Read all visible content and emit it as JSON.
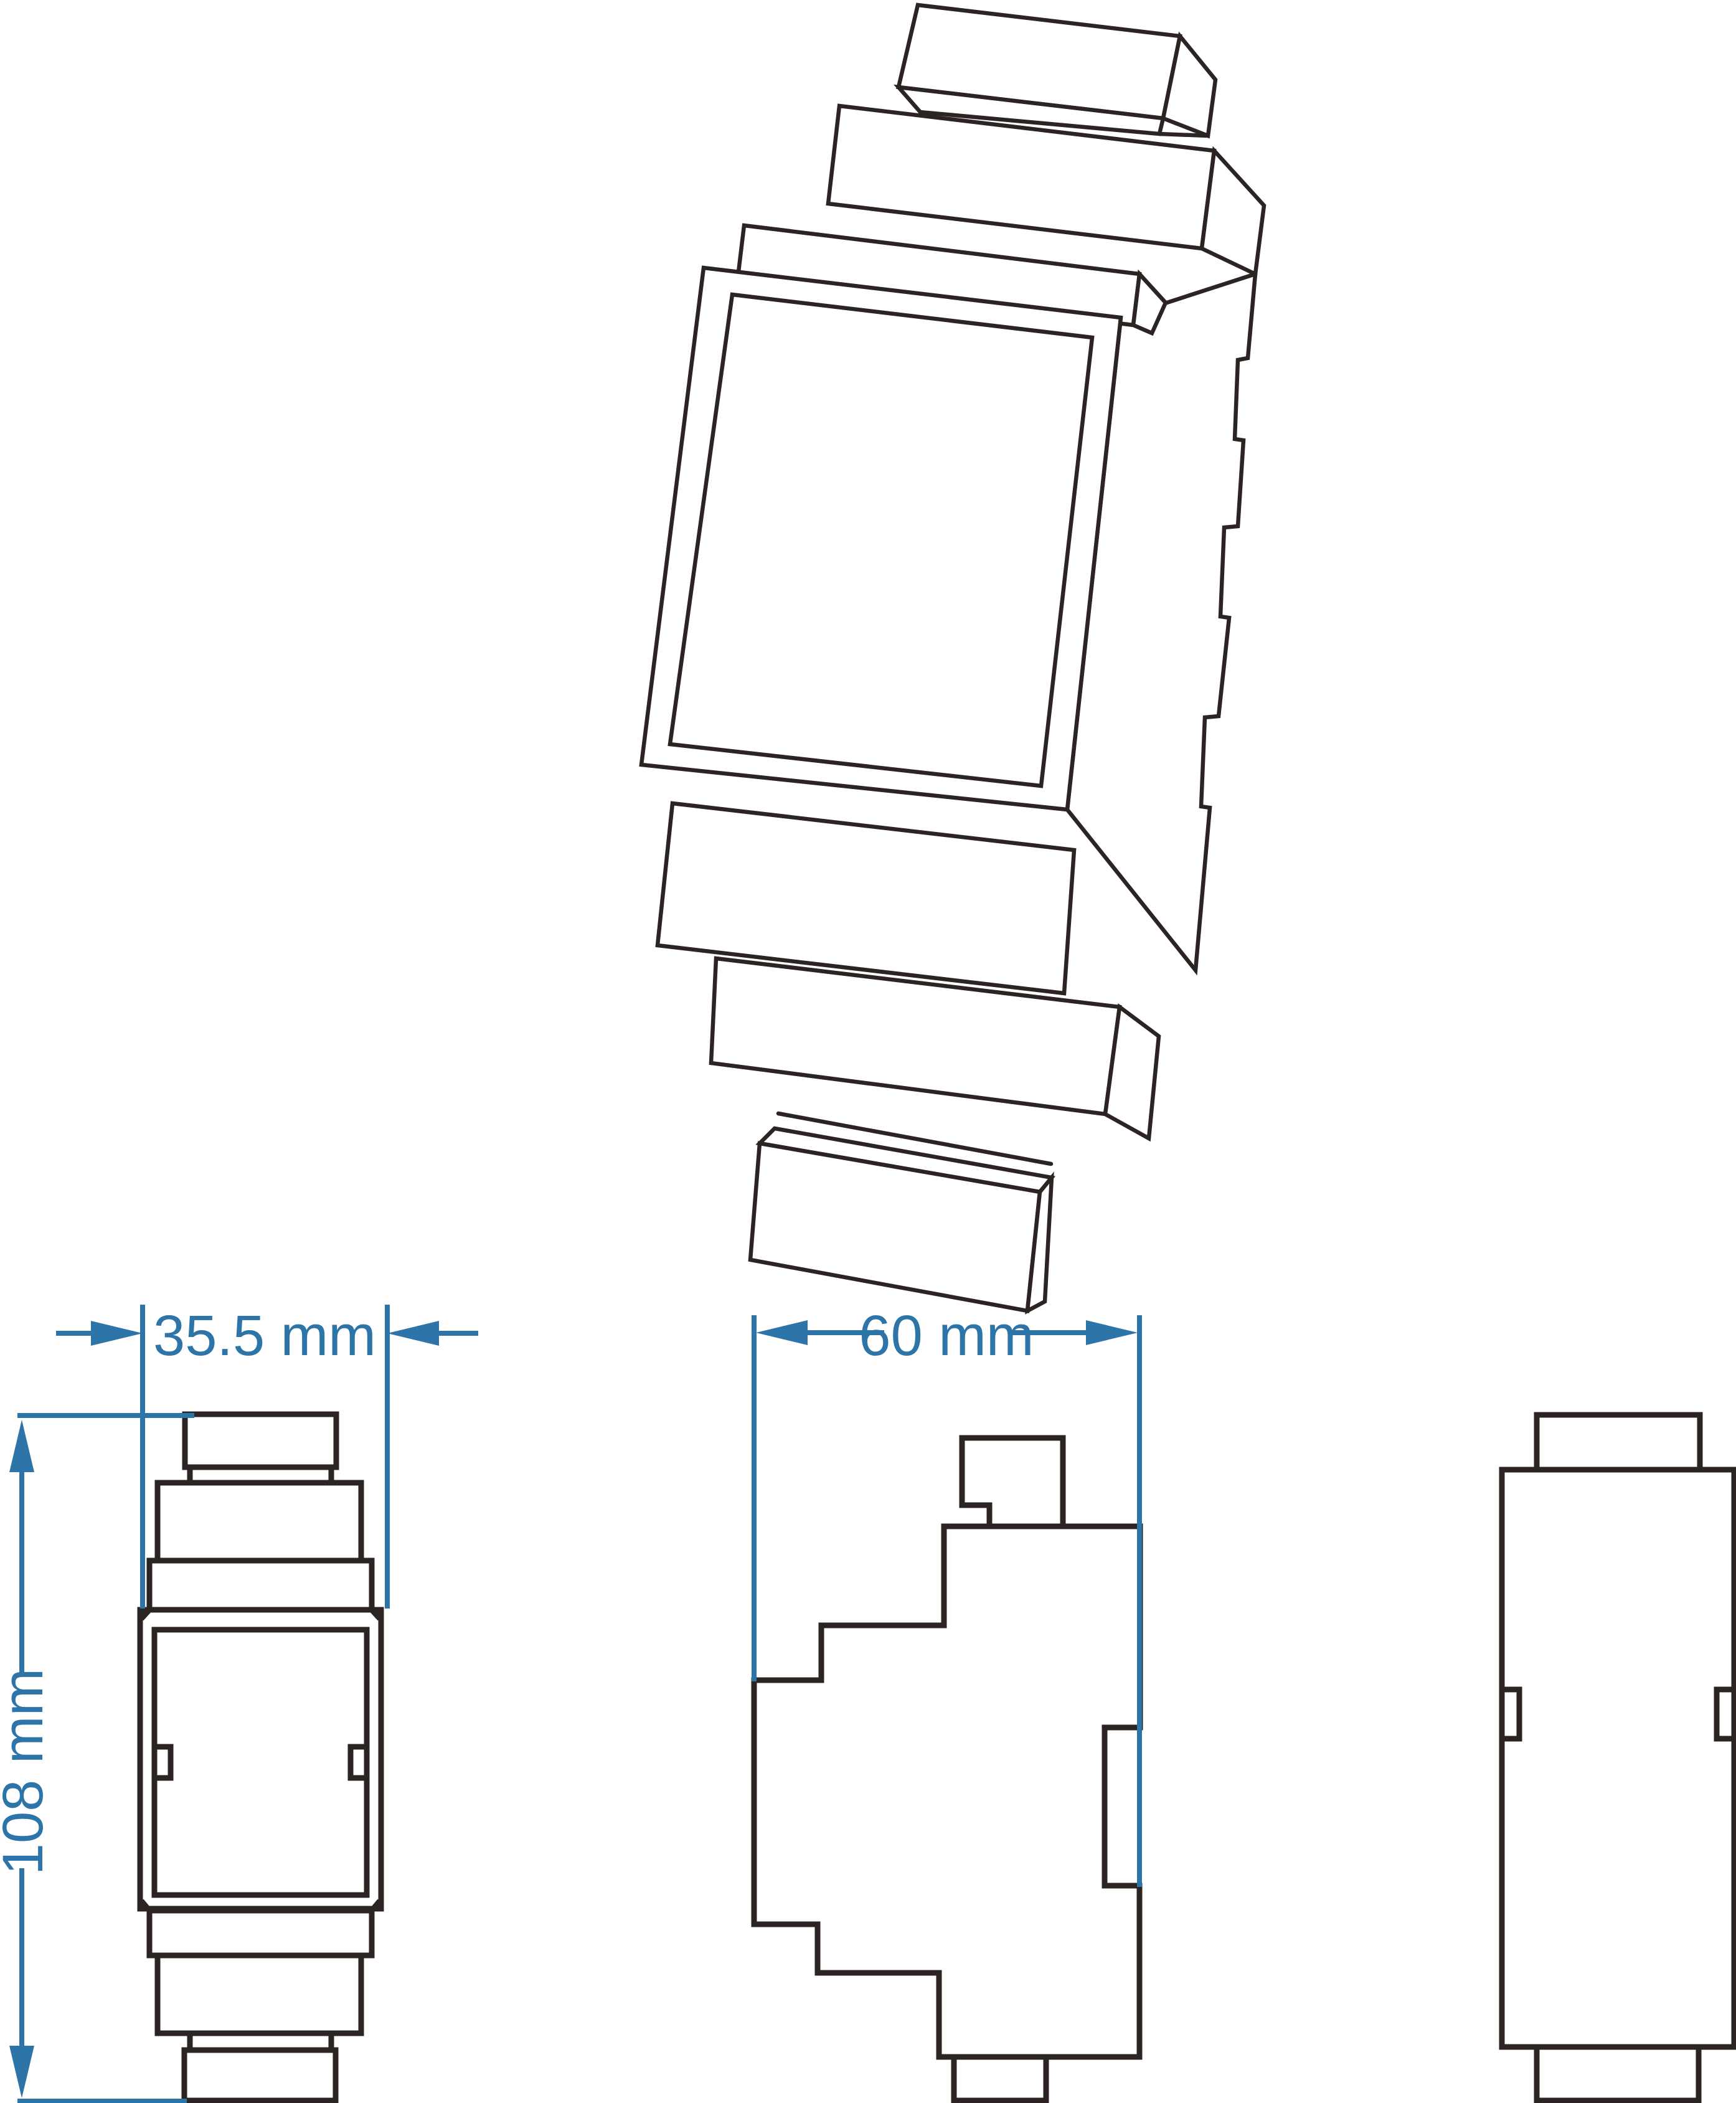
{
  "drawing": {
    "title": "",
    "views": {
      "isometric": {
        "description_label": ""
      },
      "front": {
        "description_label": ""
      },
      "side": {
        "description_label": ""
      },
      "rear": {
        "description_label": ""
      }
    },
    "dimensions": {
      "front_width": {
        "label": "35.5 mm"
      },
      "side_depth": {
        "label": "60 mm"
      },
      "front_height": {
        "label": "108 mm"
      }
    },
    "colors": {
      "dimension_blue": "#2d74a8",
      "line_ink": "#2b2422",
      "background": "#ffffff"
    }
  }
}
